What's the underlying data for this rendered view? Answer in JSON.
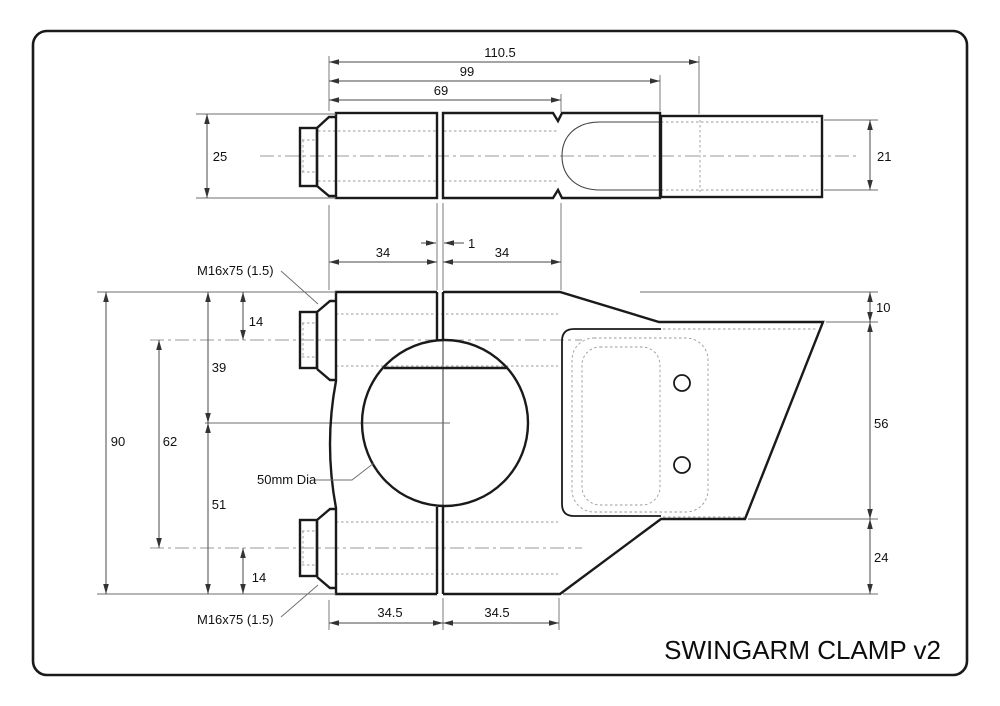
{
  "title": "SWINGARM CLAMP v2",
  "labels": {
    "bolt_spec_top": "M16x75 (1.5)",
    "bolt_spec_bottom": "M16x75 (1.5)",
    "bore_diameter": "50mm Dia"
  },
  "dimensions": {
    "top_view": {
      "overall_length": "110.5",
      "clamp_length": "99",
      "slot_depth": "69",
      "body_width": "25",
      "shaft_diameter": "21",
      "left_half": "34",
      "split_gap": "1",
      "right_half": "34"
    },
    "front_view": {
      "total_height": "90",
      "bolt_spacing": "62",
      "top_to_center": "39",
      "center_to_bottom": "51",
      "top_to_bolt": "14",
      "bolt_to_bottom": "14",
      "bracket_top_offset": "10",
      "bracket_height": "56",
      "bracket_bottom_offset": "24",
      "left_half_width": "34.5",
      "right_half_width": "34.5"
    }
  },
  "colors": {
    "line": "#1a1a1a",
    "background": "#ffffff"
  }
}
